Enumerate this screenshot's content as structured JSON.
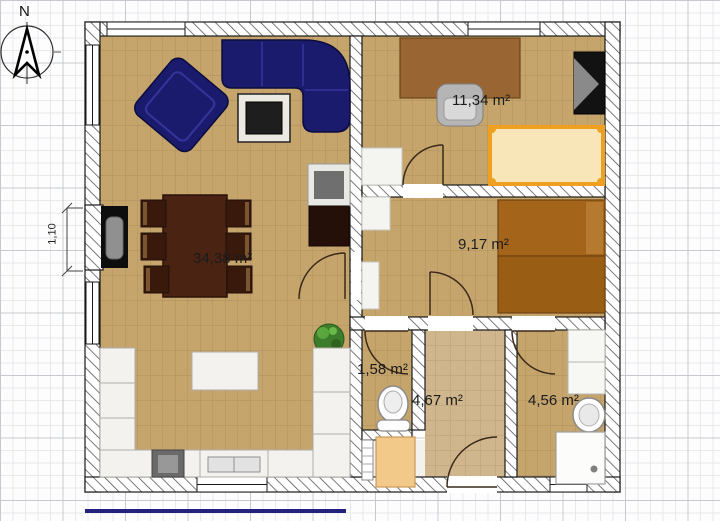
{
  "compass": {
    "label": "N"
  },
  "dimension": {
    "label": "1,10"
  },
  "rooms": {
    "living": {
      "area_label": "34,38 m²"
    },
    "bedroom_large": {
      "area_label": "11,34 m²"
    },
    "bedroom_small": {
      "area_label": "9,17 m²"
    },
    "wc": {
      "area_label": "1,58 m²"
    },
    "hall": {
      "area_label": "4,67 m²"
    },
    "bathroom": {
      "area_label": "4,56 m²"
    }
  },
  "colors": {
    "wood_floor": "#c6a56d",
    "tile_floor": "#cfb68d",
    "sofa_navy": "#1b1b6e",
    "bed_frame_orange": "#f0a021",
    "bed_brown": "#a4651b",
    "dining_brown": "#4a2312",
    "baseline_blue": "#23237d"
  }
}
